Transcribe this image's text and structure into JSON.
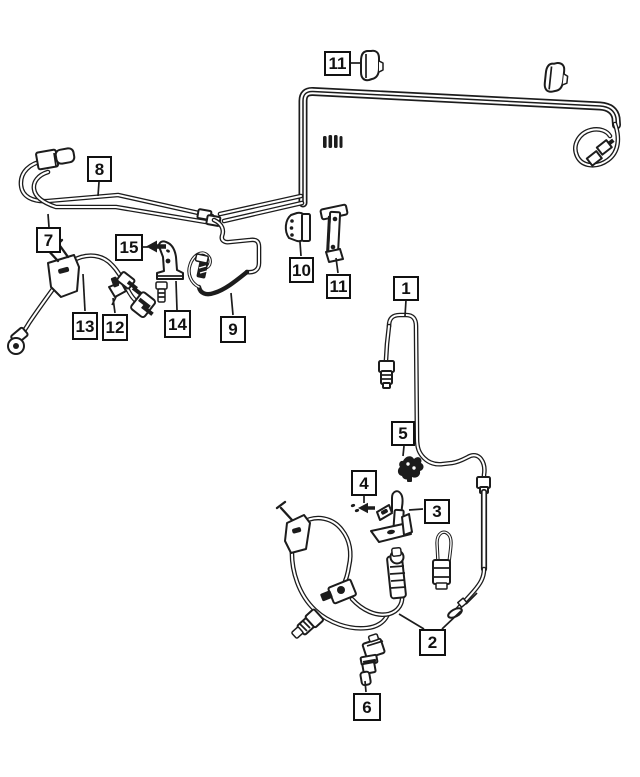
{
  "diagram": {
    "kind": "brake-lines-and-hoses parts diagram, black line art on white",
    "callouts": [
      {
        "id": "11-top",
        "label": "11"
      },
      {
        "id": "8",
        "label": "8"
      },
      {
        "id": "7",
        "label": "7"
      },
      {
        "id": "15",
        "label": "15"
      },
      {
        "id": "13",
        "label": "13"
      },
      {
        "id": "12",
        "label": "12"
      },
      {
        "id": "14",
        "label": "14"
      },
      {
        "id": "9",
        "label": "9"
      },
      {
        "id": "10",
        "label": "10"
      },
      {
        "id": "11-mid",
        "label": "11"
      },
      {
        "id": "1",
        "label": "1"
      },
      {
        "id": "5",
        "label": "5"
      },
      {
        "id": "4",
        "label": "4"
      },
      {
        "id": "3",
        "label": "3"
      },
      {
        "id": "2",
        "label": "2"
      },
      {
        "id": "6",
        "label": "6"
      }
    ]
  },
  "colors": {
    "background": "#ffffff",
    "line": "#1c1c1c",
    "callout_border": "#111111",
    "callout_text": "#111111"
  }
}
